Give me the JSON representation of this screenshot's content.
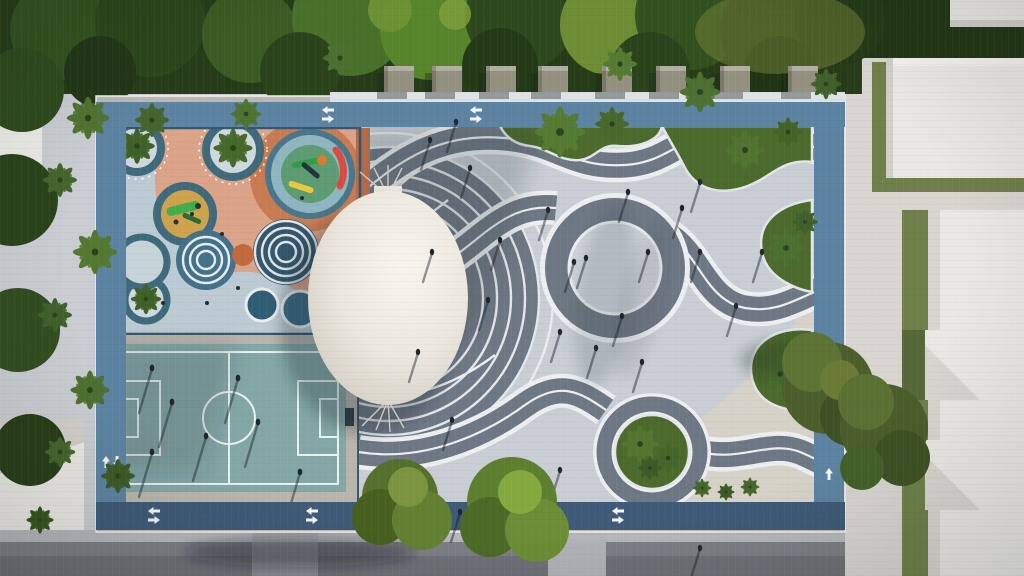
{
  "meta": {
    "scene": "aerial-architectural-render-of-urban-park",
    "view": "top-down-drone",
    "time_of_day": "late-afternoon-long-shadows"
  },
  "scene": {
    "park_features": [
      "kids-playground",
      "multi-sport-court",
      "event-dome-canopy",
      "wave-pattern-plaza",
      "perimeter-bike-lane",
      "palm-planting-beds",
      "kiosk-row"
    ],
    "counts": {
      "kiosks": 8,
      "playground-circles": 10,
      "crosswalks": 2
    },
    "surroundings": [
      "tree-canopy-north",
      "palm-row-west",
      "white-rooftop-buildings-east",
      "street-south"
    ]
  },
  "colors": {
    "tree_dark": "#263c18",
    "tree_mid": "#3b5a23",
    "tree_bright": "#58812c",
    "tree_yellow": "#7d9038",
    "palm_green": "#4f7330",
    "paving_light": "#c9ced4",
    "paving_warm": "#d6d2c8",
    "paver_frame": "#bcb8b0",
    "band_dark": "#6e7884",
    "band_white": "#eceef0",
    "inner_circle": "#ced3d9",
    "court_teal": "#83a7a6",
    "court_line": "#e9f2f0",
    "play_base": "#bccbd3",
    "play_salmon": "#dd9f81",
    "play_terracotta": "#c87b53",
    "play_brick": "#b06a4a",
    "play_teal_ring": "#3f6a7c",
    "play_navy": "#33566b",
    "sand_yellow": "#cfa24c",
    "equip_green": "#3fae4e",
    "spinner_red": "#d84b41",
    "spinner_yellow": "#e8c93e",
    "pool_blue": "#2f5d74",
    "dome_white": "#f2efe8",
    "dome_shade": "#d5d0c5",
    "lane_blue": "#5c83a1",
    "lane_navy": "#3e5a77",
    "arrow_white": "#f2f5f7",
    "road_gray": "#7b7e84",
    "road_dark": "#6c6f75",
    "curb_gray": "#b5b7bb",
    "sidewalk": "#d8d5d1",
    "building_white": "#eae8e4",
    "building_shade": "#d2cfc9",
    "hedge_green": "#6e7f4a",
    "bed_green": "#4c6a2c",
    "cabana_gray": "#93907f"
  }
}
